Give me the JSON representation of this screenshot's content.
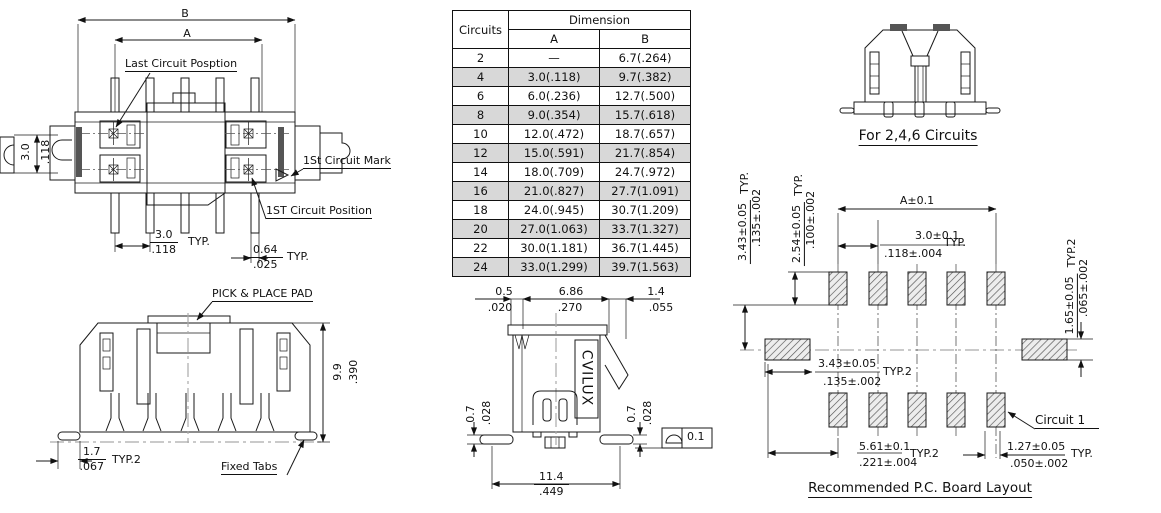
{
  "labels": {
    "typ": "TYP.",
    "typ2": "TYP.2"
  },
  "top_view": {
    "dim_b": "B",
    "dim_a": "A",
    "last_circuit": "Last Circuit Posption",
    "first_mark": "1St Circuit Mark",
    "first_position": "1ST Circuit Position",
    "row_pitch_mm": "3.0",
    "row_pitch_in": ".118",
    "pitch_mm": "3.0",
    "pitch_in": ".118",
    "tab_mm": "0.64",
    "tab_in": ".025"
  },
  "table": {
    "header_circuits": "Circuits",
    "header_dimension": "Dimension",
    "header_a": "A",
    "header_b": "B",
    "rows": [
      {
        "c": "2",
        "a": "—",
        "b": "6.7(.264)"
      },
      {
        "c": "4",
        "a": "3.0(.118)",
        "b": "9.7(.382)"
      },
      {
        "c": "6",
        "a": "6.0(.236)",
        "b": "12.7(.500)"
      },
      {
        "c": "8",
        "a": "9.0(.354)",
        "b": "15.7(.618)"
      },
      {
        "c": "10",
        "a": "12.0(.472)",
        "b": "18.7(.657)"
      },
      {
        "c": "12",
        "a": "15.0(.591)",
        "b": "21.7(.854)"
      },
      {
        "c": "14",
        "a": "18.0(.709)",
        "b": "24.7(.972)"
      },
      {
        "c": "16",
        "a": "21.0(.827)",
        "b": "27.7(1.091)"
      },
      {
        "c": "18",
        "a": "24.0(.945)",
        "b": "30.7(1.209)"
      },
      {
        "c": "20",
        "a": "27.0(1.063)",
        "b": "33.7(1.327)"
      },
      {
        "c": "22",
        "a": "30.0(1.181)",
        "b": "36.7(1.445)"
      },
      {
        "c": "24",
        "a": "33.0(1.299)",
        "b": "39.7(1.563)"
      }
    ]
  },
  "circuits_246": {
    "caption": "For 2,4,6 Circuits"
  },
  "side_view": {
    "pick_place": "PICK & PLACE PAD",
    "height_mm": "9.9",
    "height_in": ".390",
    "tab_mm": "1.7",
    "tab_in": ".067",
    "fixed_tabs": "Fixed Tabs"
  },
  "front_view": {
    "dim1_mm": "0.5",
    "dim1_in": ".020",
    "dim2_mm": "6.86",
    "dim2_in": ".270",
    "dim3_mm": "1.4",
    "dim3_in": ".055",
    "brand": "CVILUX",
    "foot_mm": "0.7",
    "foot_in": ".028",
    "width_mm": "11.4",
    "width_in": ".449",
    "flatness": "0.1"
  },
  "pcb": {
    "title": "Recommended P.C. Board Layout",
    "dim_a": "A±0.1",
    "pitch_mm": "3.0±0.1",
    "pitch_in": ".118±.004",
    "row_mm": "3.43±0.05",
    "row_in": ".135±.002",
    "pad_len_mm": "2.54±0.05",
    "pad_len_in": ".100±.002",
    "pad_h_mm": "1.65±0.05",
    "pad_h_in": ".065±.002",
    "offset_mm": "3.43±0.05",
    "offset_in": ".135±.002",
    "span_mm": "5.61±0.1",
    "span_in": ".221±.004",
    "last_mm": "1.27±0.05",
    "last_in": ".050±.002",
    "circuit1": "Circuit 1"
  }
}
